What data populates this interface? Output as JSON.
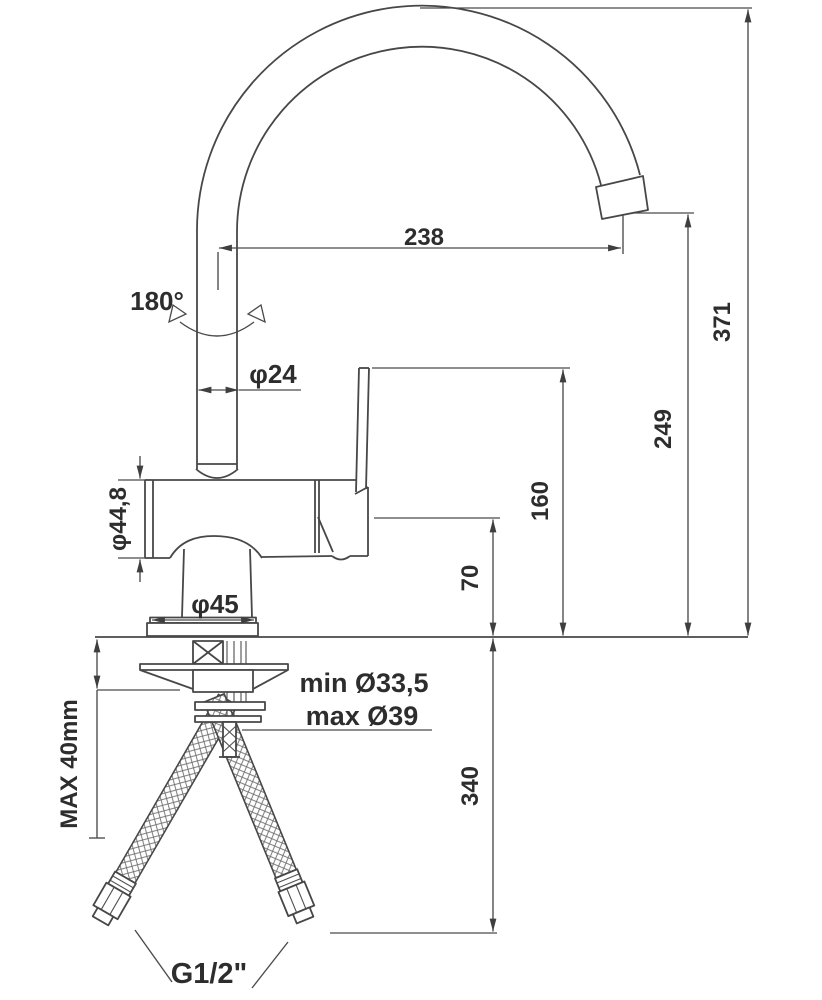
{
  "drawing": {
    "type": "technical-dimension-drawing",
    "subject": "kitchen mixer faucet with high swivel spout, side view with installation hoses",
    "colors": {
      "background": "#ffffff",
      "outline": "#474747",
      "dimension_lines": "#4a4a4a",
      "text": "#2d2d2d"
    },
    "dimensions": {
      "spout_reach": "238",
      "overall_height": "371",
      "spout_outlet_height": "249",
      "lever_top_height": "160",
      "body_top_height": "70",
      "hose_drop_length": "340",
      "swivel_angle": "180°",
      "spout_tube_diameter": "φ24",
      "body_diameter": "φ44,8",
      "base_diameter": "φ45",
      "mounting_hole_min": "min Ø33,5",
      "mounting_hole_max": "max Ø39",
      "max_deck_thickness": "MAX 40mm",
      "hose_thread": "G1/2\""
    }
  }
}
